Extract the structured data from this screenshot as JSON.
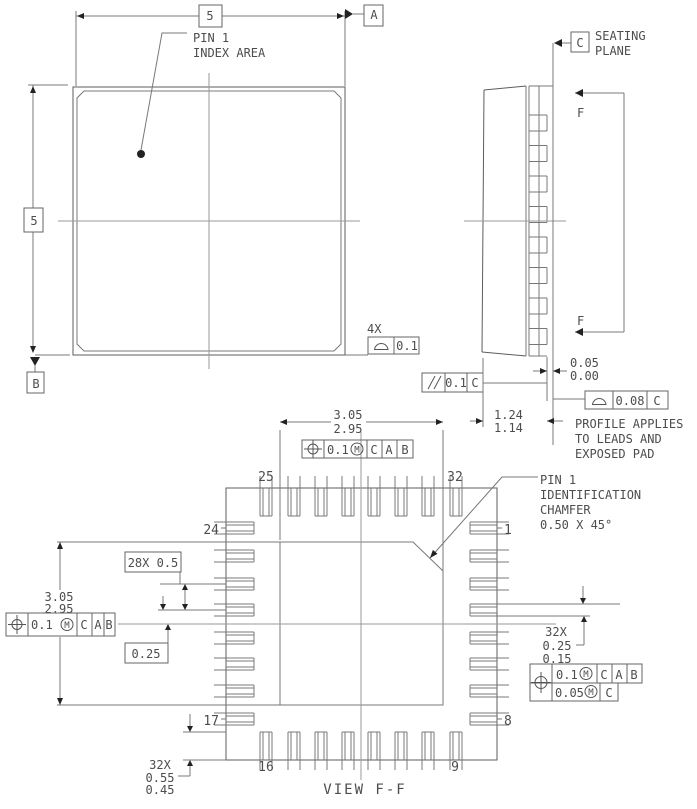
{
  "top_view": {
    "width_dim": "5",
    "height_dim": "5",
    "datum_a": "A",
    "datum_b": "B",
    "pin1_note": [
      "PIN 1",
      "INDEX AREA"
    ],
    "lead_profile": {
      "count": "4X",
      "tolerance": "0.1"
    },
    "parallelism": {
      "tolerance": "0.1",
      "datum": "C"
    }
  },
  "side_view": {
    "datum_c": "C",
    "seating_plane": [
      "SEATING",
      "PLANE"
    ],
    "section_f_top": "F",
    "section_f_bottom": "F",
    "standoff": [
      "0.05",
      "0.00"
    ],
    "height": [
      "1.24",
      "1.14"
    ],
    "profile_tol": {
      "tolerance": "0.08",
      "datum": "C"
    },
    "profile_note": [
      "PROFILE APPLIES",
      "TO LEADS AND",
      "EXPOSED PAD"
    ]
  },
  "bottom_view": {
    "title": "VIEW F-F",
    "epad_width": [
      "3.05",
      "2.95"
    ],
    "epad_height": [
      "3.05",
      "2.95"
    ],
    "frame_top": {
      "tol": "0.1",
      "m": "M",
      "d1": "C",
      "d2": "A",
      "d3": "B"
    },
    "frame_left": {
      "tol": "0.1",
      "m": "M",
      "d1": "C",
      "d2": "A",
      "d3": "B"
    },
    "frame_right": {
      "row1_tol": "0.1",
      "row1_m": "M",
      "row1_d1": "C",
      "row1_d2": "A",
      "row1_d3": "B",
      "row2_tol": "0.05",
      "row2_m": "M",
      "row2_d1": "C"
    },
    "pitch": "28X 0.5",
    "center_offset": "0.25",
    "lead_width": [
      "32X",
      "0.25",
      "0.15"
    ],
    "lead_length": [
      "32X",
      "0.55",
      "0.45"
    ],
    "pin1_chamfer_note": [
      "PIN 1",
      "IDENTIFICATION",
      "CHAMFER",
      "0.50 X 45°"
    ],
    "pins": {
      "p25": "25",
      "p32": "32",
      "p24": "24",
      "p1": "1",
      "p17": "17",
      "p8": "8",
      "p16": "16",
      "p9": "9"
    }
  }
}
